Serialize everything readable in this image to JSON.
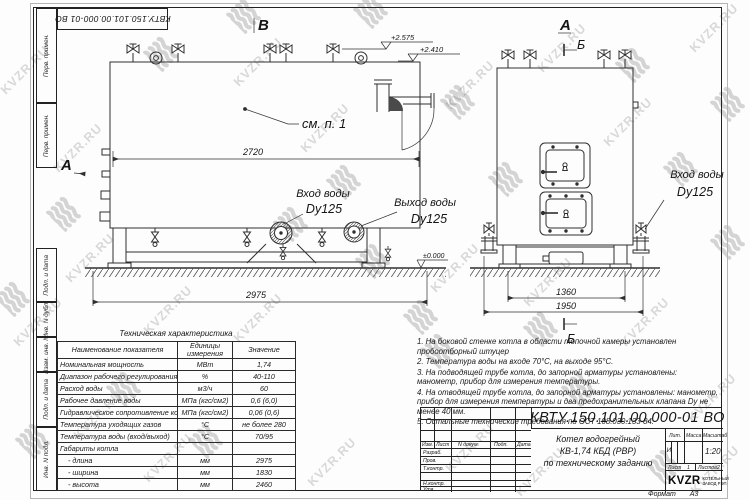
{
  "sheet": {
    "stamp_designation": "КВТУ.150.101.00.000-01 ВО",
    "watermark_text": "KVZR.RU",
    "format_label": "Формат",
    "format_value": "А3",
    "margin_labels": [
      "Перв. примен.",
      "Перв. примен.",
      "Подп. и дата",
      "Инв. N дубл.",
      "Взам. инв. N",
      "Подп. и дата",
      "Инв. N подл."
    ]
  },
  "drawing": {
    "view_markers": {
      "front_top": "В",
      "front_left": "А",
      "side_top": "А",
      "section_top": "Б",
      "section_bottom": "Б"
    },
    "callout_note": "см. п. 1",
    "elevations": {
      "valves_top": "+2.575",
      "boiler_top": "+2.410",
      "ground": "±0.000"
    },
    "dimensions": {
      "front_body_length": "2720",
      "front_overall_length": "2975",
      "side_frame_width": "1360",
      "side_overall_width": "1950"
    },
    "labels": {
      "front_inlet_title": "Вход воды",
      "front_inlet_size": "Dy125",
      "front_outlet_title": "Выход воды",
      "front_outlet_size": "Dy125",
      "side_inlet_title": "Вход воды",
      "side_inlet_size": "Dy125"
    }
  },
  "tech_table": {
    "title": "Техническая характеристика",
    "headers": [
      "Наименование показателя",
      "Единицы измерения",
      "Значение"
    ],
    "rows": [
      [
        "Номинальная мощность",
        "МВт",
        "1,74"
      ],
      [
        "Диапазон рабочего регулирования",
        "%",
        "40-110"
      ],
      [
        "Расход воды",
        "м3/ч",
        "60"
      ],
      [
        "Рабочее давление воды",
        "МПа (кгс/см2)",
        "0,6 (6,0)"
      ],
      [
        "Гидравлическое сопротивление котла",
        "МПа (кгс/см2)",
        "0,06 (0,6)"
      ],
      [
        "Температура уходящих газов",
        "°С",
        "не более 280"
      ],
      [
        "Температура воды (вход/выход)",
        "°С",
        "70/95"
      ],
      [
        "Габариты котла",
        "",
        ""
      ],
      [
        "    - длина",
        "мм",
        "2975"
      ],
      [
        "    - ширина",
        "мм",
        "1830"
      ],
      [
        "    - высота",
        "мм",
        "2460"
      ]
    ]
  },
  "notes": [
    "1. На боковой стенке котла в области топочной камеры установлен пробоотборный штуцер",
    "2. Температура воды на входе 70°С, на выходе 95°С.",
    "3. На подводящей трубе котла, до запорной арматуры установлены: манометр, прибор для измерения температуры.",
    "4. На отводящей трубе котла, до запорной арматуры установлены: манометр, прибор для измерения температуры и два предохранительных клапана Dу не менее 40 мм.",
    "5. Остальные технические требования по ОСТ 108.030.133-84."
  ],
  "title_block": {
    "designation": "КВТУ.150.101.00.000-01 ВО",
    "product_lines": [
      "Котел водогрейный",
      "КВ-1,74 КБД (РВР)",
      "по техническому заданию"
    ],
    "header_cells": [
      "Изм.",
      "Лист",
      "N докум.",
      "Подп.",
      "Дата"
    ],
    "role_rows": [
      "Разраб.",
      "Пров.",
      "Т.контр.",
      "Н.контр.",
      "Утв."
    ],
    "lit_label": "Лит.",
    "mass_label": "Масса",
    "scale_label": "Масштаб",
    "lit_value": "И",
    "scale_value": "1:20",
    "sheet_label": "Лист",
    "sheet_value": "1",
    "sheets_label": "Листов",
    "sheets_value": "2",
    "logo_text": "KVZR",
    "logo_subtext": "КОТЕЛЬНЫЙ ЗАВОД РЭП"
  }
}
